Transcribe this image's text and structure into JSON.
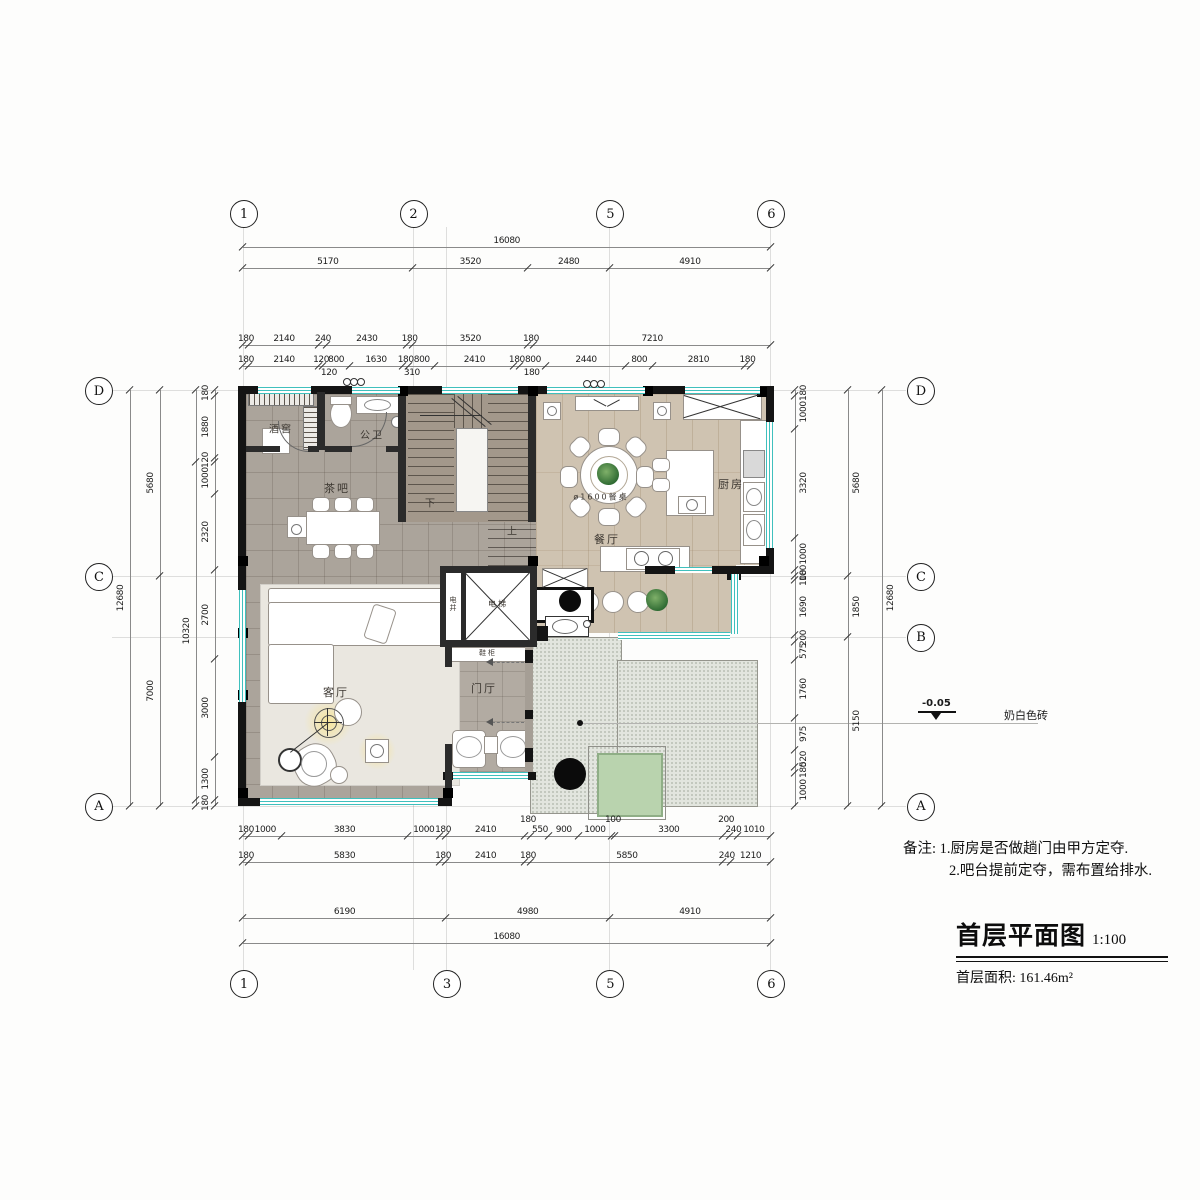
{
  "colors": {
    "wall": "#141414",
    "win": "#3fc0bd",
    "terr": "#e2e5de",
    "pad": "#b9d3ae"
  },
  "title_block": {
    "notes_prefix": "备注: ",
    "notes": [
      "1.厨房是否做趟门由甲方定夺.",
      "2.吧台提前定夺，需布置给排水."
    ],
    "title": "首层平面图",
    "scale": "1:100",
    "area": "首层面积: 161.46m²"
  },
  "annotations": {
    "level": "-0.05",
    "finish_label": "奶白色砖"
  },
  "rooms": [
    {
      "id": "wine-cellar",
      "label": "酒窖",
      "x": 281,
      "y": 428,
      "size": 10
    },
    {
      "id": "bathroom",
      "label": "公卫",
      "x": 372,
      "y": 434,
      "size": 10
    },
    {
      "id": "tea-bar",
      "label": "茶吧",
      "x": 337,
      "y": 488,
      "size": 11
    },
    {
      "id": "dining",
      "label": "餐厅",
      "x": 607,
      "y": 539,
      "size": 11
    },
    {
      "id": "kitchen",
      "label": "厨房",
      "x": 731,
      "y": 484,
      "size": 11
    },
    {
      "id": "living",
      "label": "客厅",
      "x": 336,
      "y": 692,
      "size": 11
    },
    {
      "id": "foyer",
      "label": "门厅",
      "x": 484,
      "y": 688,
      "size": 11
    },
    {
      "id": "elevator",
      "label": "电梯",
      "x": 498,
      "y": 604,
      "size": 8
    },
    {
      "id": "shaft",
      "label": "电井",
      "x": 453,
      "y": 604,
      "size": 7,
      "vertical": true
    },
    {
      "id": "shoe-cabinet",
      "label": "鞋柜",
      "x": 488,
      "y": 653,
      "size": 7
    },
    {
      "id": "stair-down",
      "label": "下",
      "x": 431,
      "y": 502,
      "size": 10
    },
    {
      "id": "stair-up",
      "label": "上",
      "x": 513,
      "y": 530,
      "size": 10
    },
    {
      "id": "dining-table",
      "label": "ø1600餐桌",
      "x": 601,
      "y": 497,
      "size": 8
    }
  ],
  "grid": {
    "px_per_mm": 0.0328,
    "origin_x": 243,
    "origin_y": 390,
    "v_mm": [
      0,
      5170,
      6190,
      11170,
      16080
    ],
    "h_mm": [
      0,
      5680,
      7530,
      12680
    ],
    "bubbles": {
      "top": {
        "cy": 213,
        "items": [
          {
            "label": "1",
            "mm": 0
          },
          {
            "label": "2",
            "mm": 5170
          },
          {
            "label": "5",
            "mm": 11170
          },
          {
            "label": "6",
            "mm": 16080
          }
        ]
      },
      "bottom": {
        "cy": 983,
        "items": [
          {
            "label": "1",
            "mm": 0
          },
          {
            "label": "3",
            "mm": 6190
          },
          {
            "label": "5",
            "mm": 11170
          },
          {
            "label": "6",
            "mm": 16080
          }
        ]
      },
      "left": {
        "cx": 98,
        "items": [
          {
            "label": "D",
            "mm": 0
          },
          {
            "label": "C",
            "mm": 5680
          },
          {
            "label": "A",
            "mm": 12680
          }
        ]
      },
      "right": {
        "cx": 920,
        "items": [
          {
            "label": "D",
            "mm": 0
          },
          {
            "label": "C",
            "mm": 5680
          },
          {
            "label": "B",
            "mm": 7530
          },
          {
            "label": "A",
            "mm": 12680
          }
        ]
      }
    }
  },
  "dimensions": [
    {
      "id": "top-total",
      "orient": "h",
      "line": 247,
      "segments": [
        16080
      ]
    },
    {
      "id": "top-major",
      "orient": "h",
      "line": 268,
      "segments": [
        5170,
        3520,
        2480,
        4910
      ]
    },
    {
      "id": "top-mid",
      "orient": "h",
      "line": 345,
      "segments": [
        180,
        2140,
        240,
        2430,
        180,
        3520,
        180,
        7210
      ]
    },
    {
      "id": "top-fine",
      "orient": "h",
      "line": 366,
      "segments": [
        180,
        2140,
        120,
        800,
        1630,
        180,
        800,
        2410,
        180,
        800,
        2440,
        800,
        2810,
        180
      ],
      "extras": [
        {
          "v": "120",
          "mm": 2620
        },
        {
          "v": "310",
          "mm": 5150
        },
        {
          "v": "180",
          "mm": 8800
        }
      ]
    },
    {
      "id": "bot-fine",
      "orient": "h",
      "line": 836,
      "segments": [
        180,
        1000,
        3830,
        1000,
        180,
        2410,
        {
          "v": "180",
          "mm": 180,
          "raised": true
        },
        550,
        900,
        1000,
        {
          "v": "100",
          "mm": 100,
          "raised": true
        },
        3300,
        {
          "v": "200",
          "mm": 200,
          "raised": true
        },
        240,
        1010
      ]
    },
    {
      "id": "bot-mid",
      "orient": "h",
      "line": 862,
      "segments": [
        180,
        5830,
        180,
        2410,
        180,
        5850,
        240,
        1210
      ]
    },
    {
      "id": "bot-major",
      "orient": "h",
      "line": 918,
      "segments": [
        6190,
        4980,
        4910
      ]
    },
    {
      "id": "bot-total",
      "orient": "h",
      "line": 943,
      "segments": [
        16080
      ]
    },
    {
      "id": "left-total",
      "orient": "v",
      "line": 130,
      "dx": -9,
      "segments": [
        12680
      ]
    },
    {
      "id": "left-major",
      "orient": "v",
      "line": 160,
      "dx": -9,
      "segments": [
        5680,
        7000
      ]
    },
    {
      "id": "left-mid",
      "orient": "v",
      "line": 196,
      "dx": -9,
      "segments": [
        {
          "v": "",
          "mm": 2180
        },
        {
          "v": "10320",
          "mm": 10320
        },
        {
          "v": "",
          "mm": 180
        }
      ]
    },
    {
      "id": "left-fine",
      "orient": "v",
      "line": 215,
      "dx": -9,
      "segments": [
        180,
        1880,
        120,
        1000,
        2320,
        2700,
        3000,
        1300,
        180
      ]
    },
    {
      "id": "right-fine",
      "orient": "v",
      "line": 795,
      "dx": 9,
      "segments": [
        180,
        1000,
        3320,
        1000,
        180,
        100,
        1690,
        200,
        575,
        1760,
        975,
        520,
        180,
        1000
      ]
    },
    {
      "id": "right-major",
      "orient": "v",
      "line": 848,
      "dx": 9,
      "segments": [
        5680,
        1850,
        5150
      ]
    },
    {
      "id": "right-total",
      "orient": "v",
      "line": 882,
      "dx": 9,
      "segments": [
        12680
      ]
    }
  ]
}
